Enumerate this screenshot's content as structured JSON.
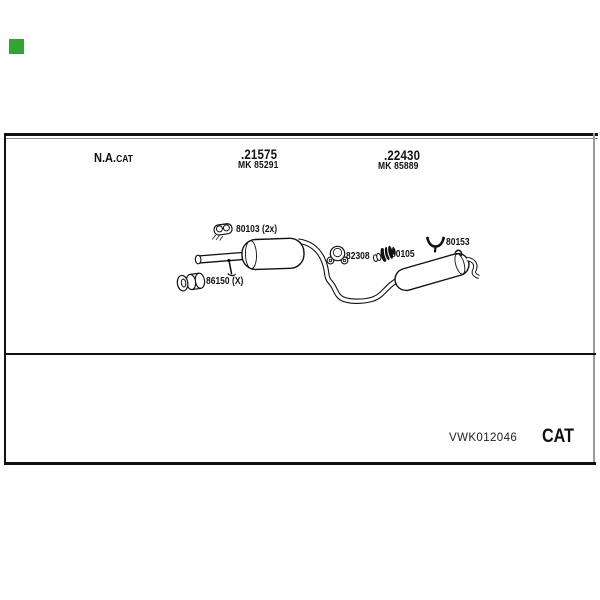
{
  "colors": {
    "marker_green": "#33a333",
    "ink": "#111111",
    "frame_gray": "#999999"
  },
  "header": {
    "na_main": "N.A.",
    "na_sub": "CAT"
  },
  "parts": {
    "group1": {
      "number": ".21575",
      "mk": "MK 85291"
    },
    "group2": {
      "number": ".22430",
      "mk": "MK 85889"
    }
  },
  "diagram": {
    "labels": {
      "clamp": "80103 (2x)",
      "mount": "86150 (X)",
      "gasket": "82308",
      "flex": "80105",
      "hanger": "80153"
    }
  },
  "footer": {
    "reference": "VWK012046",
    "brand": "CAT"
  }
}
